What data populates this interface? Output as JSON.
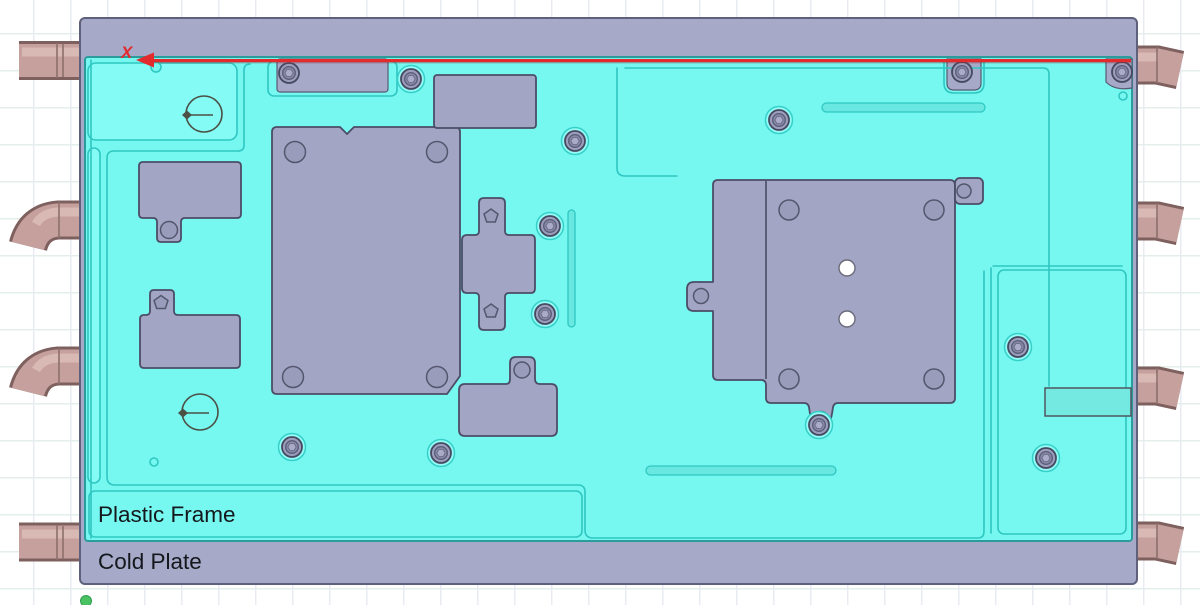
{
  "figure": {
    "type": "cad-assembly-top-view",
    "description": "Top view of a cold plate assembly with a plastic frame, mounted component blocks, screw fasteners, datum targets and coolant pipes"
  },
  "labels": {
    "plastic_frame": "Plastic Frame",
    "cold_plate": "Cold Plate"
  },
  "axis": {
    "x_label": "X"
  },
  "colors": {
    "frame": "#76f8f1",
    "frame-outline": "#2b9c9c",
    "ridge": "#2fc7c1",
    "plate": "#a7a9c8",
    "plate-outline": "#5f607c",
    "component": "#a3a5c4",
    "component-outline": "#4b4d66",
    "pipe": "#c6a09d",
    "pipe-outline": "#7e605e",
    "pipe-highlight": "#dabdb7",
    "axis-red": "#e32a2d",
    "origin-green": "#4ac162"
  }
}
